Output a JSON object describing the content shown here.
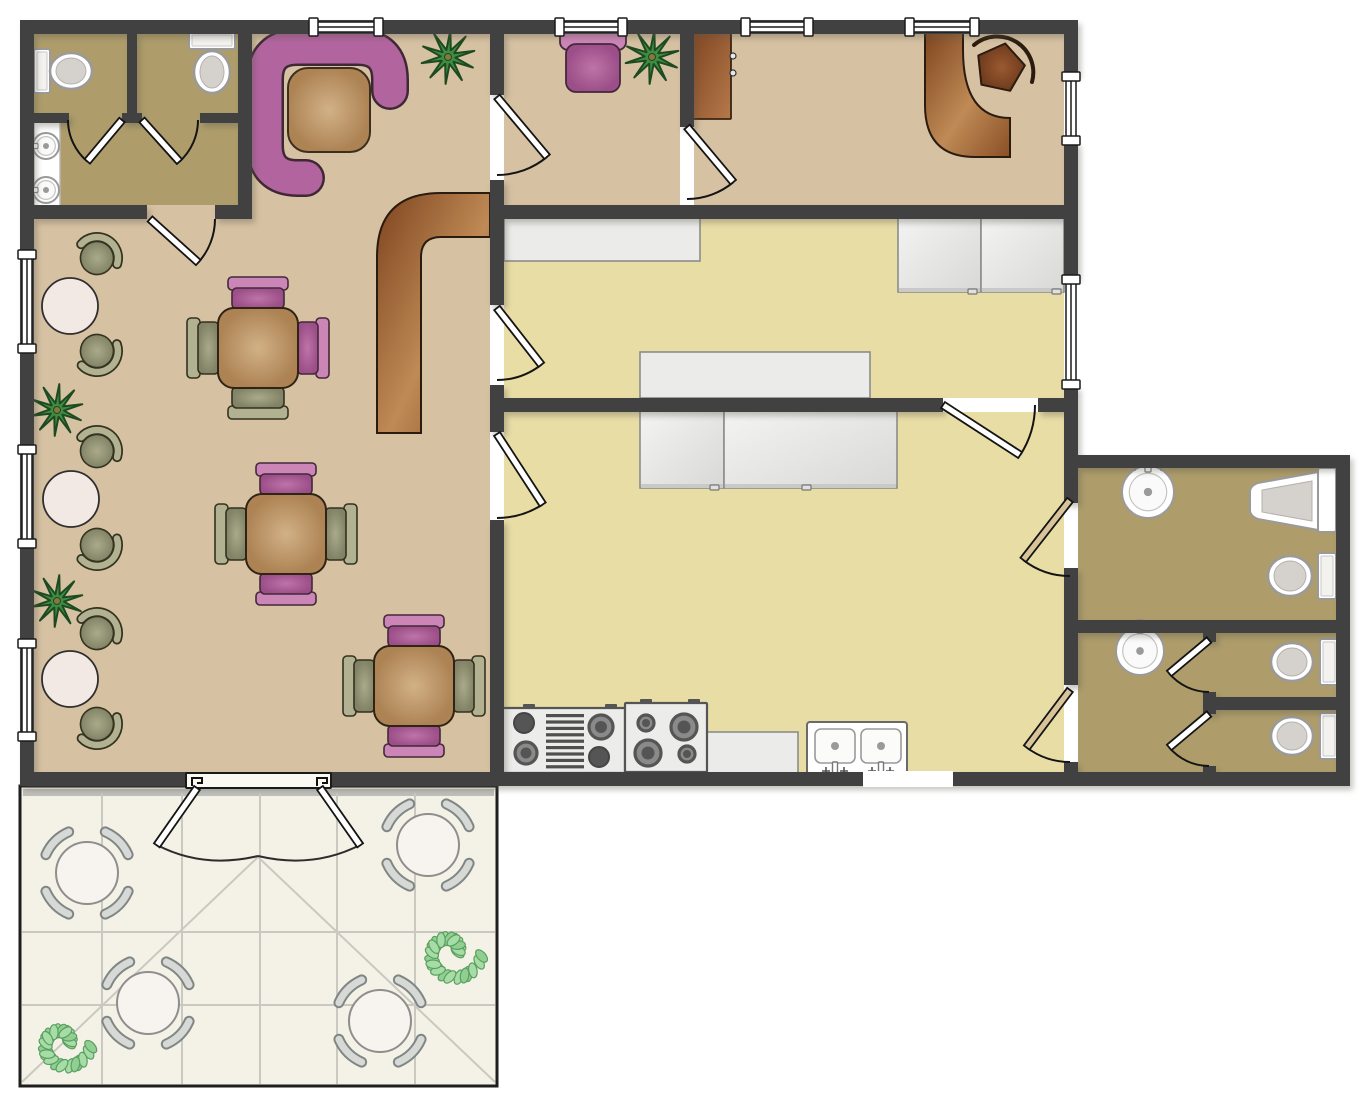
{
  "title": "cafe-floor-plan",
  "canvas": {
    "w": 1363,
    "h": 1100,
    "bg": "#ffffff"
  },
  "colors": {
    "wall": "#414141",
    "tan": "#d6c1a2",
    "yellow": "#e9dda6",
    "khaki": "#ae9d6b",
    "patio": "#f4f1e6",
    "patioBand": "#bfbfba",
    "grid": "#c9c9c2",
    "white": "#ffffff",
    "fixStroke": "#9a9a9a",
    "fixInner": "#d5d2ce",
    "purple": "#b2649e",
    "purpleDark": "#3f2836",
    "pinkBack": "#cc85b7",
    "pinkSeat": "#ab5c97",
    "oliveBack": "#b2b293",
    "oliveSeat": "#8e8e71",
    "chairStroke": "#33331f",
    "woodLight": "#d2b187",
    "woodDark": "#ad8354",
    "woodStroke": "#3c2f1f",
    "counterGray": "#ebebe9",
    "counterStroke": "#8c8c8c",
    "brown1": "#7e441f",
    "brown2": "#bf8a55",
    "plantGreen": "#3f8d42",
    "plantDark": "#1d4a20",
    "bushFill": "#a6dca6",
    "bushAlt": "#8fcf92",
    "bushStroke": "#5c9e60",
    "tableWhite": "#f3e9e4",
    "patioChair": "#d6d9d6",
    "patioChairEdge": "#7f8683",
    "doorTan": "#d9c49a",
    "doorLine": "#141414",
    "burner": "#555555"
  },
  "rooms": [
    {
      "name": "dining-room",
      "r": [
        34,
        34,
        456,
        738
      ],
      "floor": "tan"
    },
    {
      "name": "office-a",
      "r": [
        504,
        34,
        176,
        171
      ],
      "floor": "tan"
    },
    {
      "name": "office-b",
      "r": [
        694,
        34,
        370,
        171
      ],
      "floor": "tan"
    },
    {
      "name": "kitchen-1",
      "r": [
        504,
        219,
        560,
        179
      ],
      "floor": "yellow"
    },
    {
      "name": "kitchen-2",
      "r": [
        504,
        412,
        560,
        360
      ],
      "floor": "yellow"
    },
    {
      "name": "restroom-top-left",
      "r": [
        34,
        34,
        204,
        171
      ],
      "floor": "khaki"
    },
    {
      "name": "restroom-right",
      "r": [
        1078,
        468,
        258,
        304
      ],
      "floor": "khaki"
    }
  ],
  "walls": [
    [
      20,
      20,
      1058,
      14
    ],
    [
      20,
      20,
      14,
      766
    ],
    [
      20,
      772,
      1330,
      14
    ],
    [
      1064,
      20,
      14,
      55
    ],
    [
      1064,
      142,
      14,
      136
    ],
    [
      1064,
      386,
      14,
      117
    ],
    [
      1064,
      568,
      14,
      117
    ],
    [
      1064,
      762,
      14,
      24
    ],
    [
      1078,
      455,
      272,
      13
    ],
    [
      1336,
      455,
      14,
      331
    ],
    [
      490,
      20,
      14,
      75
    ],
    [
      490,
      180,
      14,
      125
    ],
    [
      490,
      385,
      14,
      47
    ],
    [
      490,
      520,
      14,
      266
    ],
    [
      680,
      20,
      14,
      107
    ],
    [
      490,
      205,
      588,
      14
    ],
    [
      490,
      398,
      453,
      14
    ],
    [
      1038,
      398,
      40,
      14
    ],
    [
      238,
      20,
      14,
      199
    ],
    [
      34,
      205,
      113,
      14
    ],
    [
      215,
      205,
      37,
      14
    ],
    [
      127,
      20,
      10,
      100
    ],
    [
      34,
      113,
      35,
      10
    ],
    [
      122,
      113,
      20,
      10
    ],
    [
      200,
      113,
      38,
      10
    ],
    [
      1078,
      620,
      258,
      13
    ],
    [
      1203,
      633,
      13,
      9
    ],
    [
      1203,
      692,
      13,
      22
    ],
    [
      1203,
      766,
      13,
      20
    ],
    [
      1203,
      697,
      133,
      13
    ]
  ],
  "windows": [
    [
      312,
      20,
      68,
      "h"
    ],
    [
      558,
      20,
      66,
      "h"
    ],
    [
      744,
      20,
      66,
      "h"
    ],
    [
      908,
      20,
      68,
      "h"
    ],
    [
      20,
      253,
      97,
      "v"
    ],
    [
      20,
      448,
      97,
      "v"
    ],
    [
      20,
      642,
      96,
      "v"
    ],
    [
      1064,
      75,
      67,
      "v"
    ],
    [
      1064,
      278,
      108,
      "v"
    ]
  ],
  "openings": [
    [
      863,
      771,
      90,
      16
    ]
  ],
  "doors": [
    {
      "h": [
        122,
        120
      ],
      "len": 54,
      "a": 130,
      "arc": [
        180,
        1
      ],
      "c": "w"
    },
    {
      "h": [
        142,
        120
      ],
      "len": 56,
      "a": 48,
      "arc": [
        0,
        0
      ],
      "c": "w"
    },
    {
      "h": [
        150,
        219
      ],
      "len": 65,
      "a": 42,
      "arc": [
        0,
        0
      ],
      "c": "w"
    },
    {
      "h": [
        497,
        97
      ],
      "len": 78,
      "a": 50,
      "arc": [
        90,
        1
      ],
      "c": "w"
    },
    {
      "h": [
        687,
        127
      ],
      "len": 72,
      "a": 50,
      "arc": [
        90,
        1
      ],
      "c": "w"
    },
    {
      "h": [
        497,
        308
      ],
      "len": 72,
      "a": 52,
      "arc": [
        90,
        1
      ],
      "c": "w"
    },
    {
      "h": [
        497,
        434
      ],
      "len": 84,
      "a": 57,
      "arc": [
        90,
        1
      ],
      "c": "w"
    },
    {
      "h": [
        943,
        405
      ],
      "len": 92,
      "a": 33,
      "arc": [
        0,
        0
      ],
      "c": "w"
    },
    {
      "h": [
        1070,
        500
      ],
      "len": 76,
      "a": 128,
      "arc": [
        90,
        0
      ],
      "c": "t"
    },
    {
      "h": [
        1070,
        690
      ],
      "len": 72,
      "a": 127,
      "arc": [
        90,
        0
      ],
      "c": "t"
    },
    {
      "h": [
        1209,
        640
      ],
      "len": 52,
      "a": 140,
      "arc": [
        90,
        0
      ],
      "c": "w"
    },
    {
      "h": [
        1209,
        714
      ],
      "len": 52,
      "a": 140,
      "arc": [
        90,
        0
      ],
      "c": "w"
    }
  ],
  "patio": {
    "rect": [
      20,
      786,
      477,
      300
    ],
    "band": [
      23,
      789,
      471,
      7
    ],
    "grid_v": [
      102,
      182,
      260,
      337,
      415
    ],
    "grid_h": [
      932,
      1005
    ],
    "diagonals": [
      [
        258,
        857,
        22,
        1082
      ],
      [
        258,
        857,
        495,
        1082
      ]
    ],
    "door": {
      "frame": [
        186,
        773,
        145,
        15
      ],
      "hooks": [
        [
          192,
          774
        ],
        [
          317,
          774
        ]
      ],
      "leaves": [
        {
          "h": [
            197,
            788
          ],
          "a": 125,
          "len": 70
        },
        {
          "h": [
            320,
            788
          ],
          "a": 55,
          "len": 70
        }
      ],
      "arcs": [
        "M157,845 Q203,869 258,856",
        "M360,845 Q313,869 258,856"
      ]
    },
    "tables": [
      [
        87,
        873
      ],
      [
        428,
        845
      ],
      [
        148,
        1003
      ],
      [
        380,
        1021
      ]
    ],
    "table_r": 31,
    "chair_r": 45,
    "bushes": [
      [
        63,
        1043,
        30
      ],
      [
        451,
        952,
        33
      ]
    ]
  },
  "furniture": {
    "booth": {
      "path": "M390,91 L390,80 Q390,47 357,47 L298,47 Q265,47 265,80 L265,145 Q265,178 298,178 L306,178",
      "table": [
        288,
        68,
        82,
        84
      ]
    },
    "palms": [
      [
        448,
        57,
        27
      ],
      [
        652,
        57,
        27
      ],
      [
        57,
        410,
        26
      ],
      [
        57,
        601,
        26
      ]
    ],
    "armchair": {
      "back": [
        560,
        30,
        66,
        20
      ],
      "seat": [
        566,
        44,
        54,
        48
      ]
    },
    "cabinet": {
      "r": [
        688,
        30,
        43,
        89
      ],
      "handles": [
        [
          733,
          56
        ],
        [
          733,
          73
        ]
      ]
    },
    "desk": {
      "path": "M925,30 L963,30 L963,50 Q963,118 1010,118 L1010,157 L975,157 Q925,157 925,105 Z"
    },
    "desk_chair": {
      "c": [
        1000,
        68
      ],
      "r": 25,
      "arc": "M974,45 A36,36 0 0 1 1032,82"
    },
    "counter_l": {
      "path": "M377,433 L377,257 Q377,193 441,193 L490,193 L490,237 L441,237 Q421,237 421,257 L421,433 Z"
    },
    "dining_sets": [
      {
        "c": [
          258,
          348
        ],
        "chairs": {
          "top": "p",
          "right": "p",
          "bottom": "o",
          "left": "o"
        }
      },
      {
        "c": [
          286,
          534
        ],
        "chairs": {
          "top": "p",
          "right": "o",
          "bottom": "p",
          "left": "o"
        }
      },
      {
        "c": [
          414,
          686
        ],
        "chairs": {
          "top": "p",
          "right": "o",
          "bottom": "p",
          "left": "o"
        }
      }
    ],
    "wall_groups": [
      {
        "table": [
          70,
          306
        ],
        "chairs": [
          [
            97,
            258,
            -61
          ],
          [
            97,
            351,
            59
          ]
        ]
      },
      {
        "table": [
          71,
          499
        ],
        "chairs": [
          [
            97,
            451,
            -61
          ],
          [
            97,
            545,
            60
          ]
        ]
      },
      {
        "table": [
          70,
          679
        ],
        "chairs": [
          [
            97,
            633,
            -60
          ],
          [
            97,
            724,
            59
          ]
        ]
      }
    ],
    "counters": [
      [
        504,
        215,
        196,
        46
      ],
      [
        640,
        352,
        230,
        46
      ],
      [
        707,
        732,
        91,
        45
      ]
    ],
    "cabinets": [
      {
        "r": [
          898,
          215,
          83,
          77
        ],
        "handle": [
          968,
          288
        ]
      },
      {
        "r": [
          981,
          215,
          83,
          77
        ],
        "handle": [
          1052,
          288
        ]
      },
      {
        "r": [
          640,
          409,
          84,
          79
        ],
        "handle": [
          710,
          484
        ]
      },
      {
        "r": [
          724,
          409,
          173,
          79
        ],
        "handle": [
          802,
          484
        ]
      }
    ],
    "stoves": [
      {
        "r": [
          502,
          708,
          123,
          65
        ],
        "ticks": [
          523,
          605
        ],
        "burners": [
          {
            "c": [
              524,
              723
            ],
            "r": 10,
            "solid": 1
          },
          {
            "c": [
              526,
              753
            ],
            "r": 11,
            "solid": 0
          },
          {
            "c": [
              601,
              727
            ],
            "r": 12,
            "solid": 0
          },
          {
            "c": [
              599,
              757
            ],
            "r": 10,
            "solid": 1
          }
        ],
        "grill": {
          "x": 546,
          "y": 714,
          "w": 38,
          "n": 9
        }
      },
      {
        "r": [
          625,
          703,
          82,
          69
        ],
        "ticks": [
          640,
          688
        ],
        "burners": [
          {
            "c": [
              646,
              723
            ],
            "r": 8,
            "solid": 0
          },
          {
            "c": [
              684,
              727
            ],
            "r": 13,
            "solid": 0
          },
          {
            "c": [
              648,
              753
            ],
            "r": 13,
            "solid": 0
          },
          {
            "c": [
              687,
              754
            ],
            "r": 8,
            "solid": 0
          }
        ]
      }
    ],
    "kitchen_sink": {
      "r": [
        807,
        722,
        100,
        56
      ],
      "basins": [
        [
          815,
          729,
          40,
          34
        ],
        [
          861,
          729,
          40,
          34
        ]
      ],
      "faucets": [
        835,
        881
      ]
    },
    "toilets": [
      {
        "tank": [
          34,
          49,
          16,
          44
        ],
        "bowl": [
          71,
          71,
          21,
          18
        ]
      },
      {
        "tank": [
          189,
          32,
          46,
          17
        ],
        "bowl": [
          212,
          72,
          18,
          21
        ]
      },
      {
        "tank": [
          1318,
          553,
          18,
          46
        ],
        "bowl": [
          1290,
          576,
          22,
          20
        ]
      },
      {
        "tank": [
          1320,
          639,
          18,
          46
        ],
        "bowl": [
          1292,
          662,
          21,
          19
        ]
      },
      {
        "tank": [
          1320,
          713,
          18,
          46
        ],
        "bowl": [
          1292,
          736,
          21,
          19
        ]
      }
    ],
    "round_sinks": [
      [
        46,
        146,
        13,
        "left"
      ],
      [
        46,
        190,
        13,
        "left"
      ],
      [
        1148,
        492,
        26,
        "up"
      ],
      [
        1140,
        651,
        24,
        "up"
      ]
    ],
    "sink_counter": [
      34,
      118,
      26,
      95
    ],
    "urinal": {
      "plate": [
        1318,
        468,
        18,
        64
      ],
      "bowl": "M1318,472 L1258,483 Q1250,486 1250,492 L1250,510 Q1250,516 1258,519 L1318,530 Z",
      "inner": "M1312,481 L1262,490 L1262,512 L1312,521 Z"
    }
  }
}
